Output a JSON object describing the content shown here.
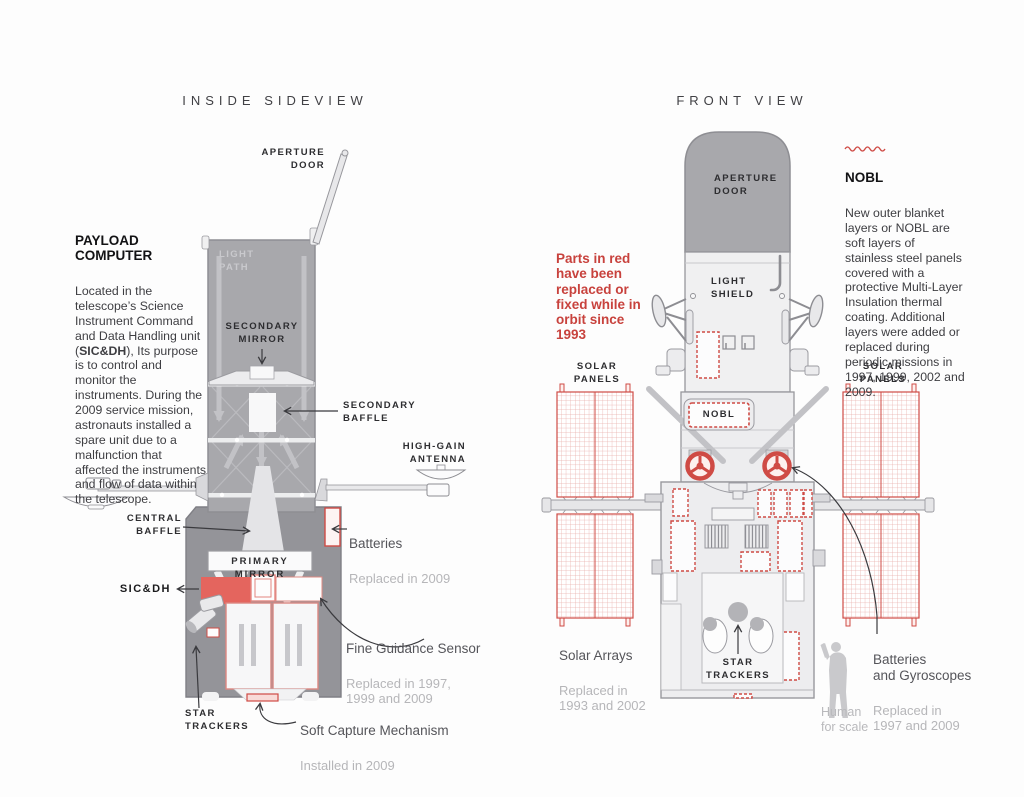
{
  "palette": {
    "red_outline": "#cf4b45",
    "red_solid": "#e4655e",
    "red_text": "#c8423d",
    "tube_gray": "#a8a8ac",
    "equipment_gray": "#949499",
    "body_light": "#ededef"
  },
  "titles": {
    "left": "INSIDE SIDEVIEW",
    "right": "FRONT VIEW"
  },
  "sideview": {
    "payload_note": {
      "heading": "PAYLOAD COMPUTER",
      "body_start": "Located in the telescope’s Science Instrument Command and Data Handling unit (",
      "body_bold": "SIC&DH",
      "body_end": "), Its purpose is to control and monitor the instruments. During the 2009 service mission, astronauts installed a spare unit due to a malfunction that affected the instruments and flow of data within the telescope."
    },
    "labels": {
      "aperture_door": "APERTURE\nDOOR",
      "light_path": "LIGHT\nPATH",
      "secondary_mirror": "SECONDARY\nMIRROR",
      "secondary_baffle": "SECONDARY\nBAFFLE",
      "high_gain_antenna": "HIGH-GAIN\nANTENNA",
      "central_baffle": "CENTRAL\nBAFFLE",
      "primary_mirror": "PRIMARY MIRROR",
      "sic_dh": "SIC&DH",
      "star_trackers": "STAR\nTRACKERS"
    },
    "annotations": {
      "batteries": {
        "title": "Batteries",
        "detail": "Replaced in 2009"
      },
      "fine_guidance_sensor": {
        "title": "Fine Guidance Sensor",
        "detail": "Replaced in 1997,\n1999 and 2009"
      },
      "soft_capture": {
        "title": "Soft Capture Mechanism",
        "detail": "Installed in 2009"
      }
    }
  },
  "frontview": {
    "red_note": "Parts in red\nhave been\nreplaced or\nfixed while in\norbit since\n1993",
    "nobl_note": {
      "heading": "NOBL",
      "body": "New outer blanket layers or NOBL are soft layers of stainless steel panels covered with a protective Multi-Layer Insulation thermal coating. Additional layers were added or replaced during periodic missions in 1997, 1999, 2002 and 2009."
    },
    "labels": {
      "aperture_door": "APERTURE\nDOOR",
      "light_shield": "LIGHT\nSHIELD",
      "solar_panels": "SOLAR\nPANELS",
      "nobl_tag": "NOBL",
      "star_trackers": "STAR\nTRACKERS"
    },
    "annotations": {
      "solar_arrays": {
        "title": "Solar Arrays",
        "detail": "Replaced in\n1993 and 2002"
      },
      "batteries_gyroscopes": {
        "title": "Batteries\nand Gyroscopes",
        "detail": "Replaced in\n1997 and 2009"
      },
      "human_scale": "Human\nfor scale"
    }
  }
}
